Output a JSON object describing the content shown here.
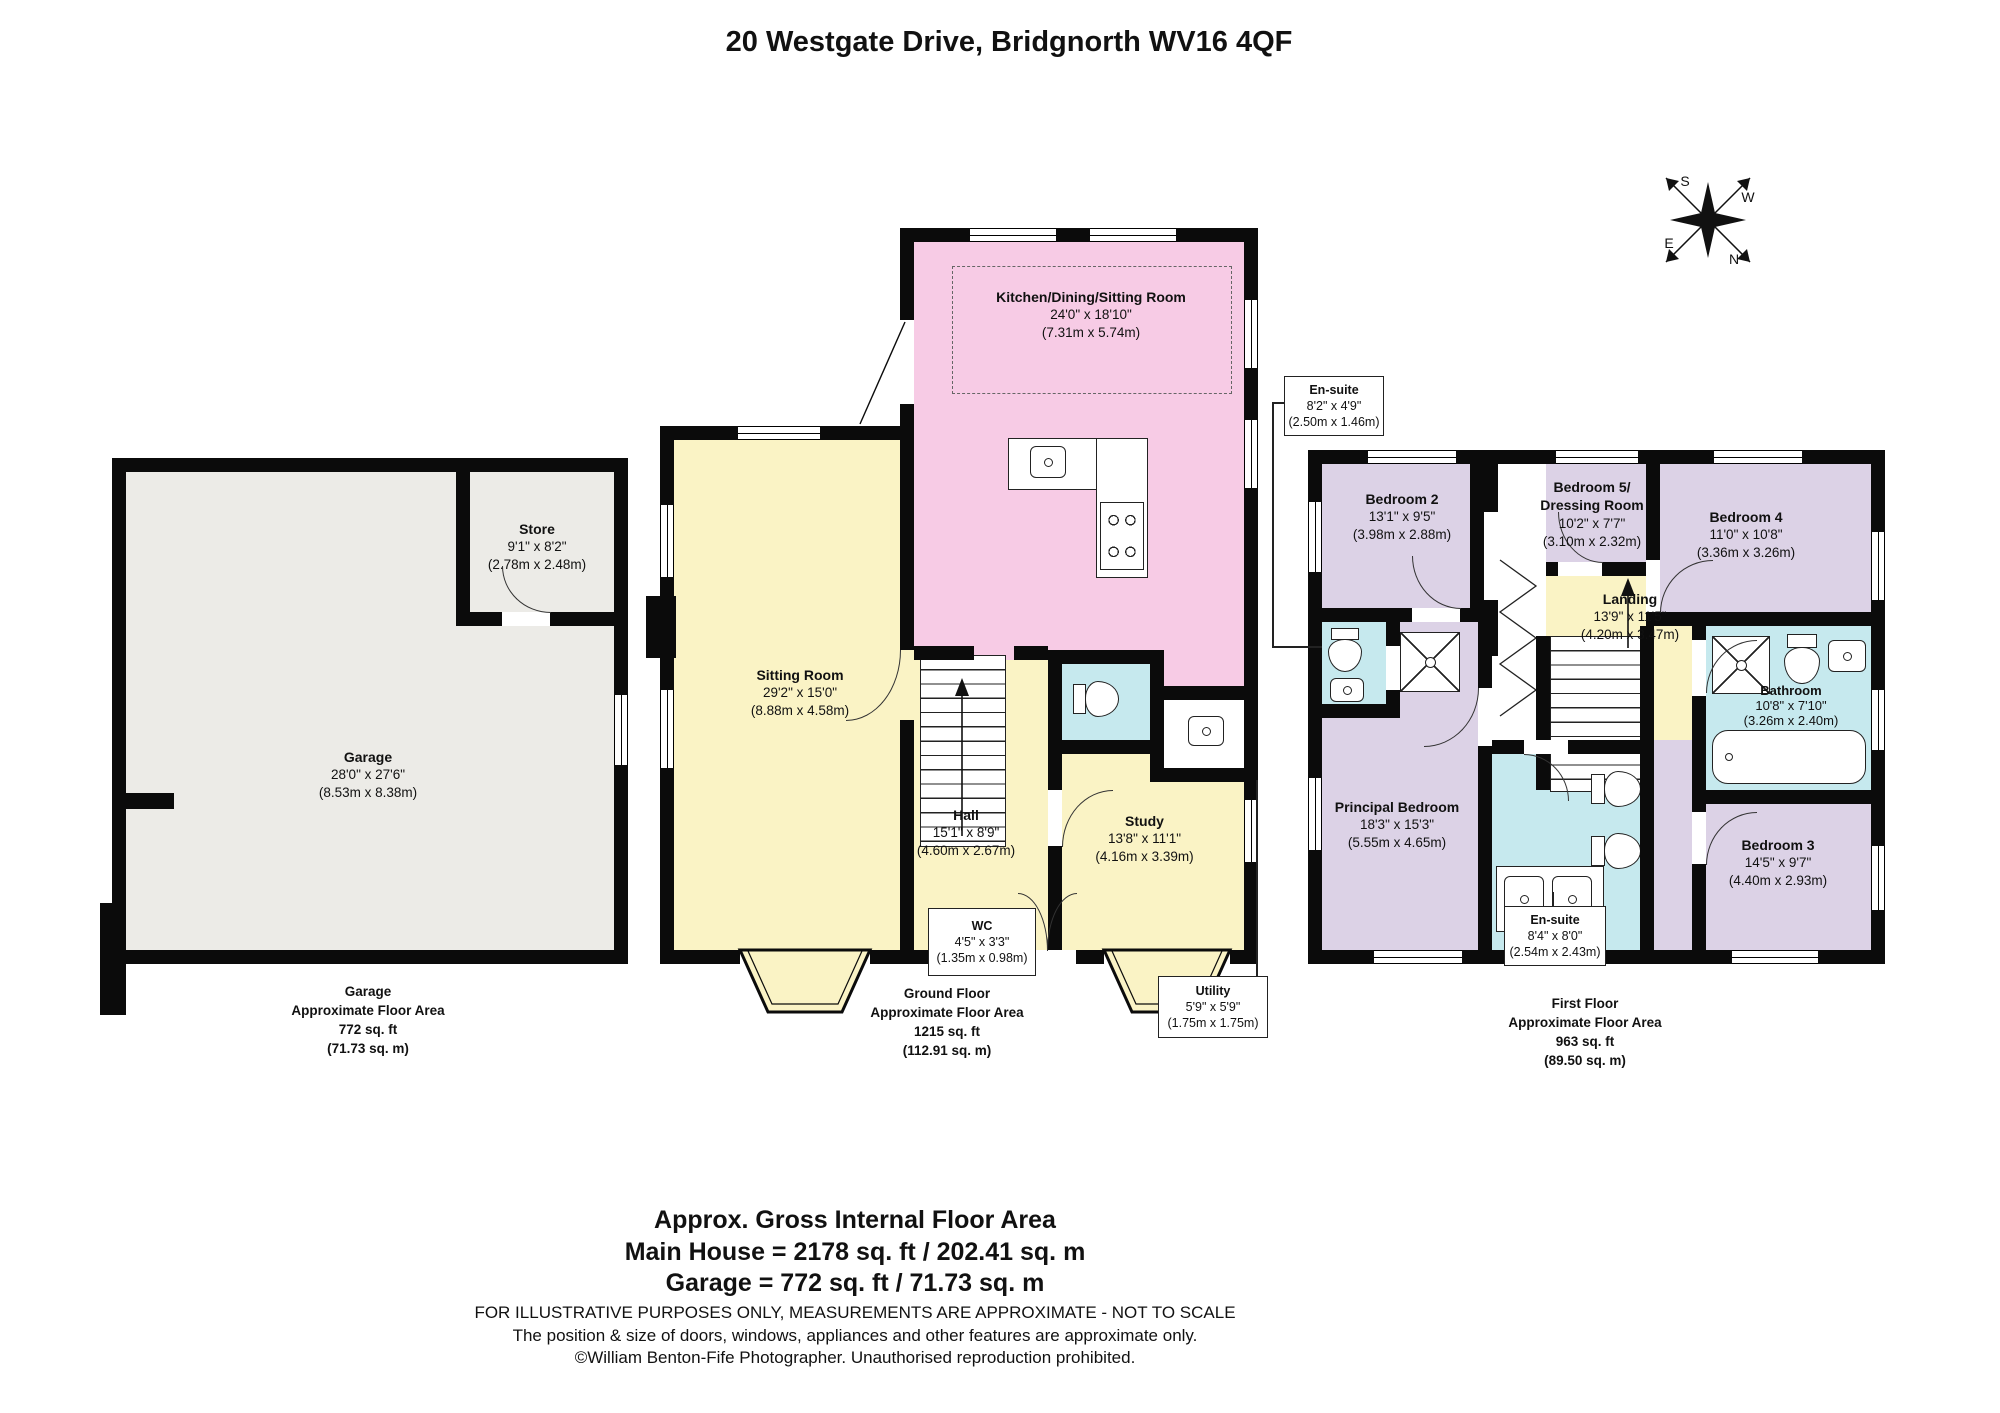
{
  "title": "20 Westgate Drive, Bridgnorth WV16 4QF",
  "compass": {
    "n": "N",
    "s": "S",
    "e": "E",
    "w": "W"
  },
  "colors": {
    "wall": "#0b0b0b",
    "garage_fill": "#ecebe7",
    "kitchen_pink": "#f7cbe5",
    "living_yellow": "#faf3c5",
    "bedroom_lavender": "#dcd2e6",
    "bath_cyan": "#c6e9ee"
  },
  "rooms": {
    "garage": {
      "name": "Garage",
      "dims": "28'0\" x 27'6\"",
      "metric": "(8.53m x 8.38m)"
    },
    "store": {
      "name": "Store",
      "dims": "9'1\" x 8'2\"",
      "metric": "(2.78m x 2.48m)"
    },
    "kitchen": {
      "name": "Kitchen/Dining/Sitting Room",
      "dims": "24'0\" x 18'10\"",
      "metric": "(7.31m x 5.74m)"
    },
    "sitting": {
      "name": "Sitting Room",
      "dims": "29'2\" x 15'0\"",
      "metric": "(8.88m x 4.58m)"
    },
    "hall": {
      "name": "Hall",
      "dims": "15'1\" x 8'9\"",
      "metric": "(4.60m x 2.67m)"
    },
    "wc": {
      "name": "WC",
      "dims": "4'5\" x 3'3\"",
      "metric": "(1.35m x 0.98m)"
    },
    "study": {
      "name": "Study",
      "dims": "13'8\" x 11'1\"",
      "metric": "(4.16m x 3.39m)"
    },
    "utility": {
      "name": "Utility",
      "dims": "5'9\" x 5'9\"",
      "metric": "(1.75m x 1.75m)"
    },
    "ensuite_top": {
      "name": "En-suite",
      "dims": "8'2\" x 4'9\"",
      "metric": "(2.50m x 1.46m)"
    },
    "bedroom2": {
      "name": "Bedroom 2",
      "dims": "13'1\" x 9'5\"",
      "metric": "(3.98m x 2.88m)"
    },
    "bedroom5": {
      "name": "Bedroom 5/",
      "name2": "Dressing Room",
      "dims": "10'2\" x 7'7\"",
      "metric": "(3.10m x 2.32m)"
    },
    "bedroom4": {
      "name": "Bedroom 4",
      "dims": "11'0\" x 10'8\"",
      "metric": "(3.36m x 3.26m)"
    },
    "landing": {
      "name": "Landing",
      "dims": "13'9\" x 11'5\"",
      "metric": "(4.20m x 3.47m)"
    },
    "bathroom": {
      "name": "Bathroom",
      "dims": "10'8\" x 7'10\"",
      "metric": "(3.26m x 2.40m)"
    },
    "principal": {
      "name": "Principal Bedroom",
      "dims": "18'3\" x 15'3\"",
      "metric": "(5.55m x 4.65m)"
    },
    "ensuite_main": {
      "name": "En-suite",
      "dims": "8'4\" x 8'0\"",
      "metric": "(2.54m x 2.43m)"
    },
    "bedroom3": {
      "name": "Bedroom 3",
      "dims": "14'5\" x 9'7\"",
      "metric": "(4.40m x 2.93m)"
    }
  },
  "footers": {
    "garage": {
      "line1": "Garage",
      "line2": "Approximate Floor Area",
      "line3": "772 sq. ft",
      "line4": "(71.73 sq. m)"
    },
    "ground": {
      "line1": "Ground Floor",
      "line2": "Approximate Floor Area",
      "line3": "1215 sq. ft",
      "line4": "(112.91 sq. m)"
    },
    "first": {
      "line1": "First Floor",
      "line2": "Approximate Floor Area",
      "line3": "963 sq. ft",
      "line4": "(89.50 sq. m)"
    }
  },
  "summary": {
    "heading": "Approx. Gross Internal Floor Area",
    "main_house": "Main House = 2178 sq. ft / 202.41 sq. m",
    "garage": "Garage = 772 sq. ft / 71.73 sq. m",
    "disclaimer1": "FOR ILLUSTRATIVE PURPOSES ONLY, MEASUREMENTS ARE APPROXIMATE - NOT TO SCALE",
    "disclaimer2": "The position & size of doors, windows, appliances and other features are approximate only.",
    "disclaimer3": "©William Benton-Fife Photographer. Unauthorised reproduction prohibited."
  }
}
